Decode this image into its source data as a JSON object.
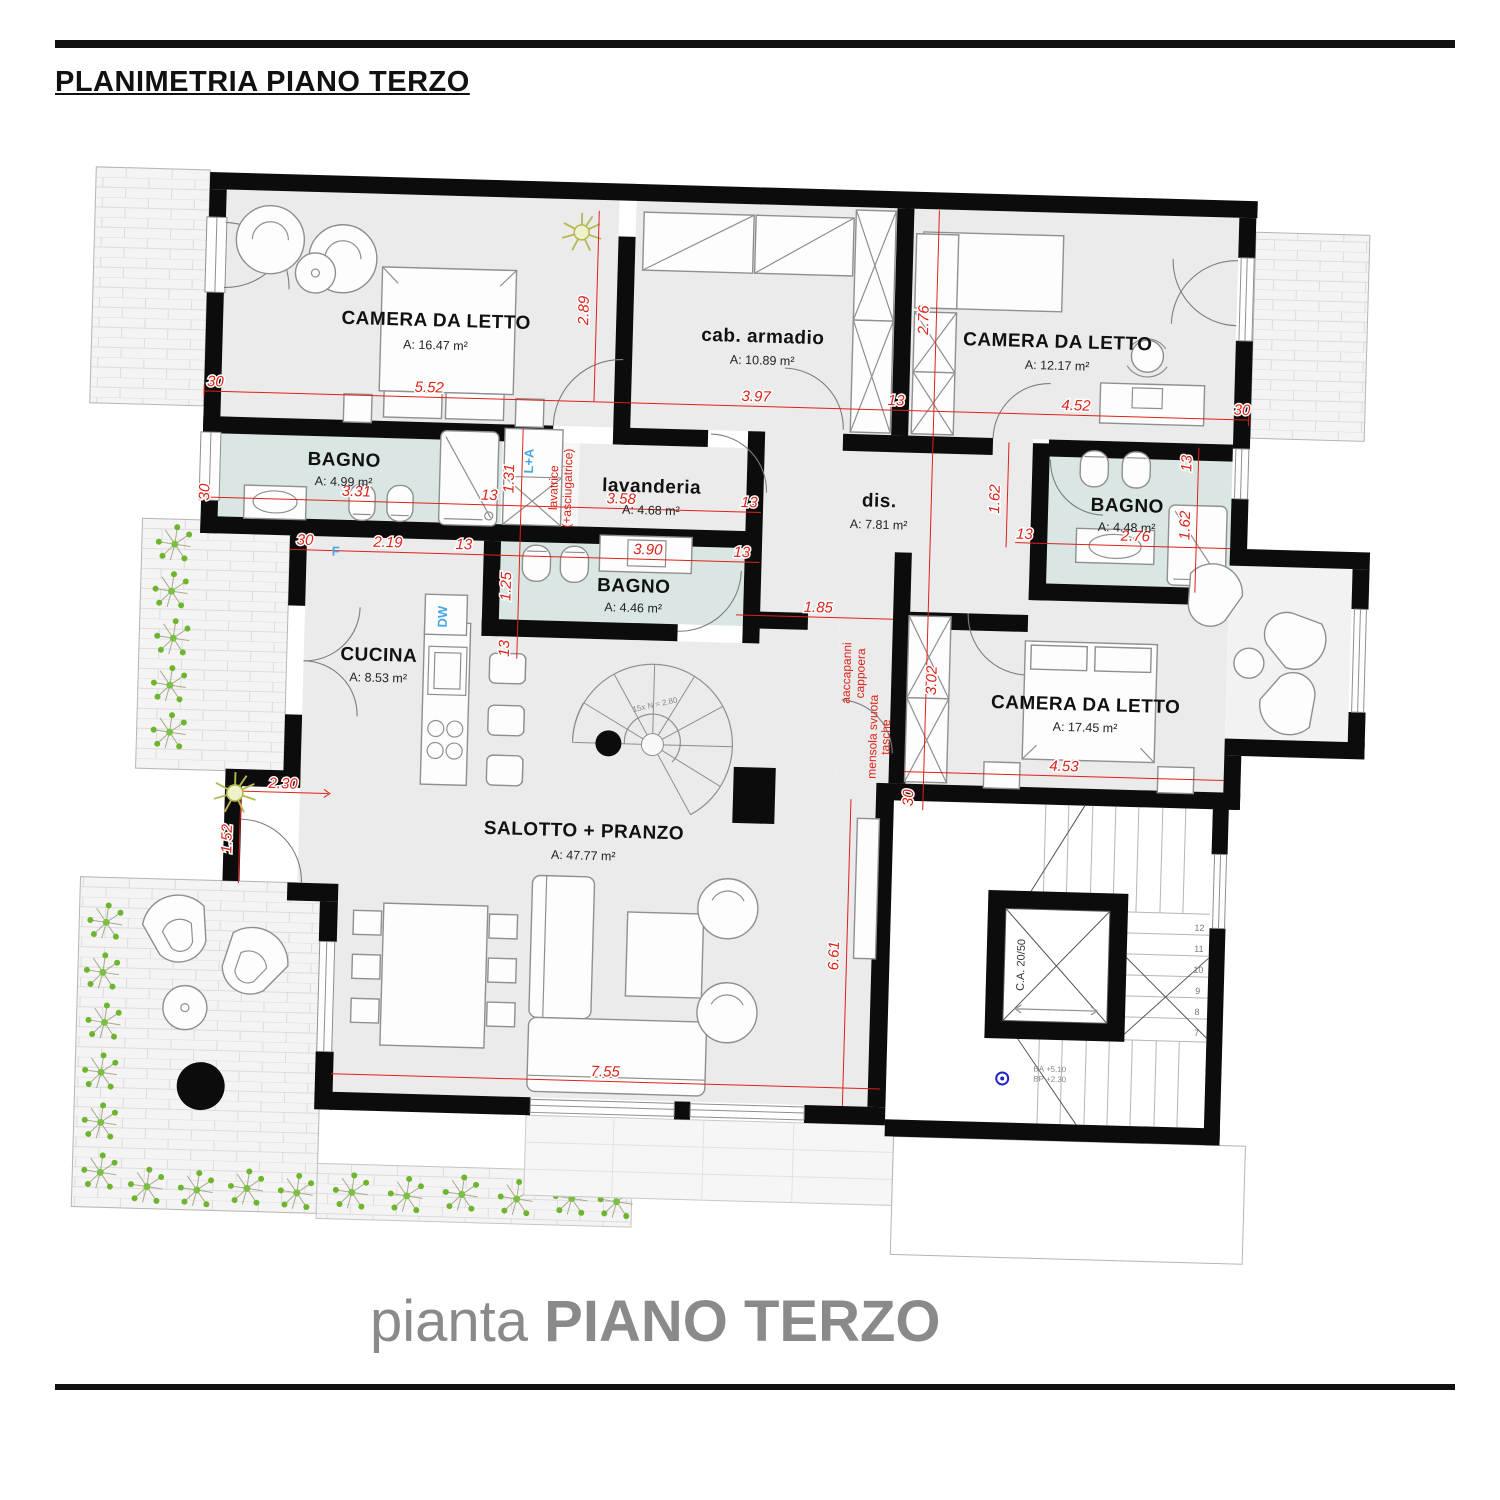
{
  "header": {
    "title": "PLANIMETRIA PIANO TERZO"
  },
  "caption": {
    "prefix": "pianta ",
    "main": "PIANO TERZO"
  },
  "rooms": {
    "camera1": {
      "name": "CAMERA DA LETTO",
      "area": "A: 16.47 m²"
    },
    "cabina": {
      "name": "cab. armadio",
      "area": "A: 10.89 m²"
    },
    "camera2": {
      "name": "CAMERA DA LETTO",
      "area": "A: 12.17 m²"
    },
    "bagno1": {
      "name": "BAGNO",
      "area": "A: 4.99 m²"
    },
    "lavanderia": {
      "name": "lavanderia",
      "area": "A: 4.68 m²"
    },
    "dis": {
      "name": "dis.",
      "area": "A: 7.81 m²"
    },
    "bagno2": {
      "name": "BAGNO",
      "area": "A: 4.48 m²"
    },
    "bagno3": {
      "name": "BAGNO",
      "area": "A: 4.46 m²"
    },
    "cucina": {
      "name": "CUCINA",
      "area": "A: 8.53 m²"
    },
    "camera3": {
      "name": "CAMERA DA LETTO",
      "area": "A: 17.45 m²"
    },
    "salotto": {
      "name": "SALOTTO + PRANZO",
      "area": "A: 47.77 m²"
    }
  },
  "dims": {
    "d1": "30",
    "d2": "5.52",
    "d3": "2.89",
    "d4": "3.97",
    "d5": "13",
    "d6": "4.52",
    "d7": "30",
    "d8": "2.76",
    "d9": "30",
    "d10": "3.31",
    "d11": "13",
    "d12": "1.31",
    "d13": "3.58",
    "d14": "13",
    "d15": "1.62",
    "d16": "13",
    "d17": "13",
    "d18": "1.62",
    "d19": "2.76",
    "d20": "30",
    "d21": "2.19",
    "d22": "13",
    "d23": "3.90",
    "d24": "13",
    "d25": "1.25",
    "d26": "13",
    "d27": "1.85",
    "d28": "3.02",
    "d29": "4.53",
    "d30": "30",
    "d31": "2.30",
    "d32": "1.52",
    "d33": "7.55",
    "d34": "6.61"
  },
  "annotations": {
    "lavatrice1": "lavatrice",
    "lavatrice2": "(+asciugatrice)",
    "app1": "aaccapanni",
    "app2": "cappoera",
    "men1": "mensola svuota",
    "men2": "tasche",
    "la": "L+A",
    "dw": "DW",
    "f": "F",
    "elevator": "C.A. 20/50",
    "spiral": "15x N = 2.80",
    "level1": "BA +5.10",
    "level2": "BP +2.30"
  },
  "stairs": {
    "t7": "7",
    "t8": "8",
    "t9": "9",
    "t10": "10",
    "t11": "11",
    "t12": "12"
  },
  "colors": {
    "wall": "#0c0c0c",
    "bath_floor": "#d9e6e3",
    "room_floor": "#ebebeb",
    "dim_red": "#dd2218",
    "accent_blue": "#45a7e8",
    "caption_gray": "#8a8a8a"
  }
}
